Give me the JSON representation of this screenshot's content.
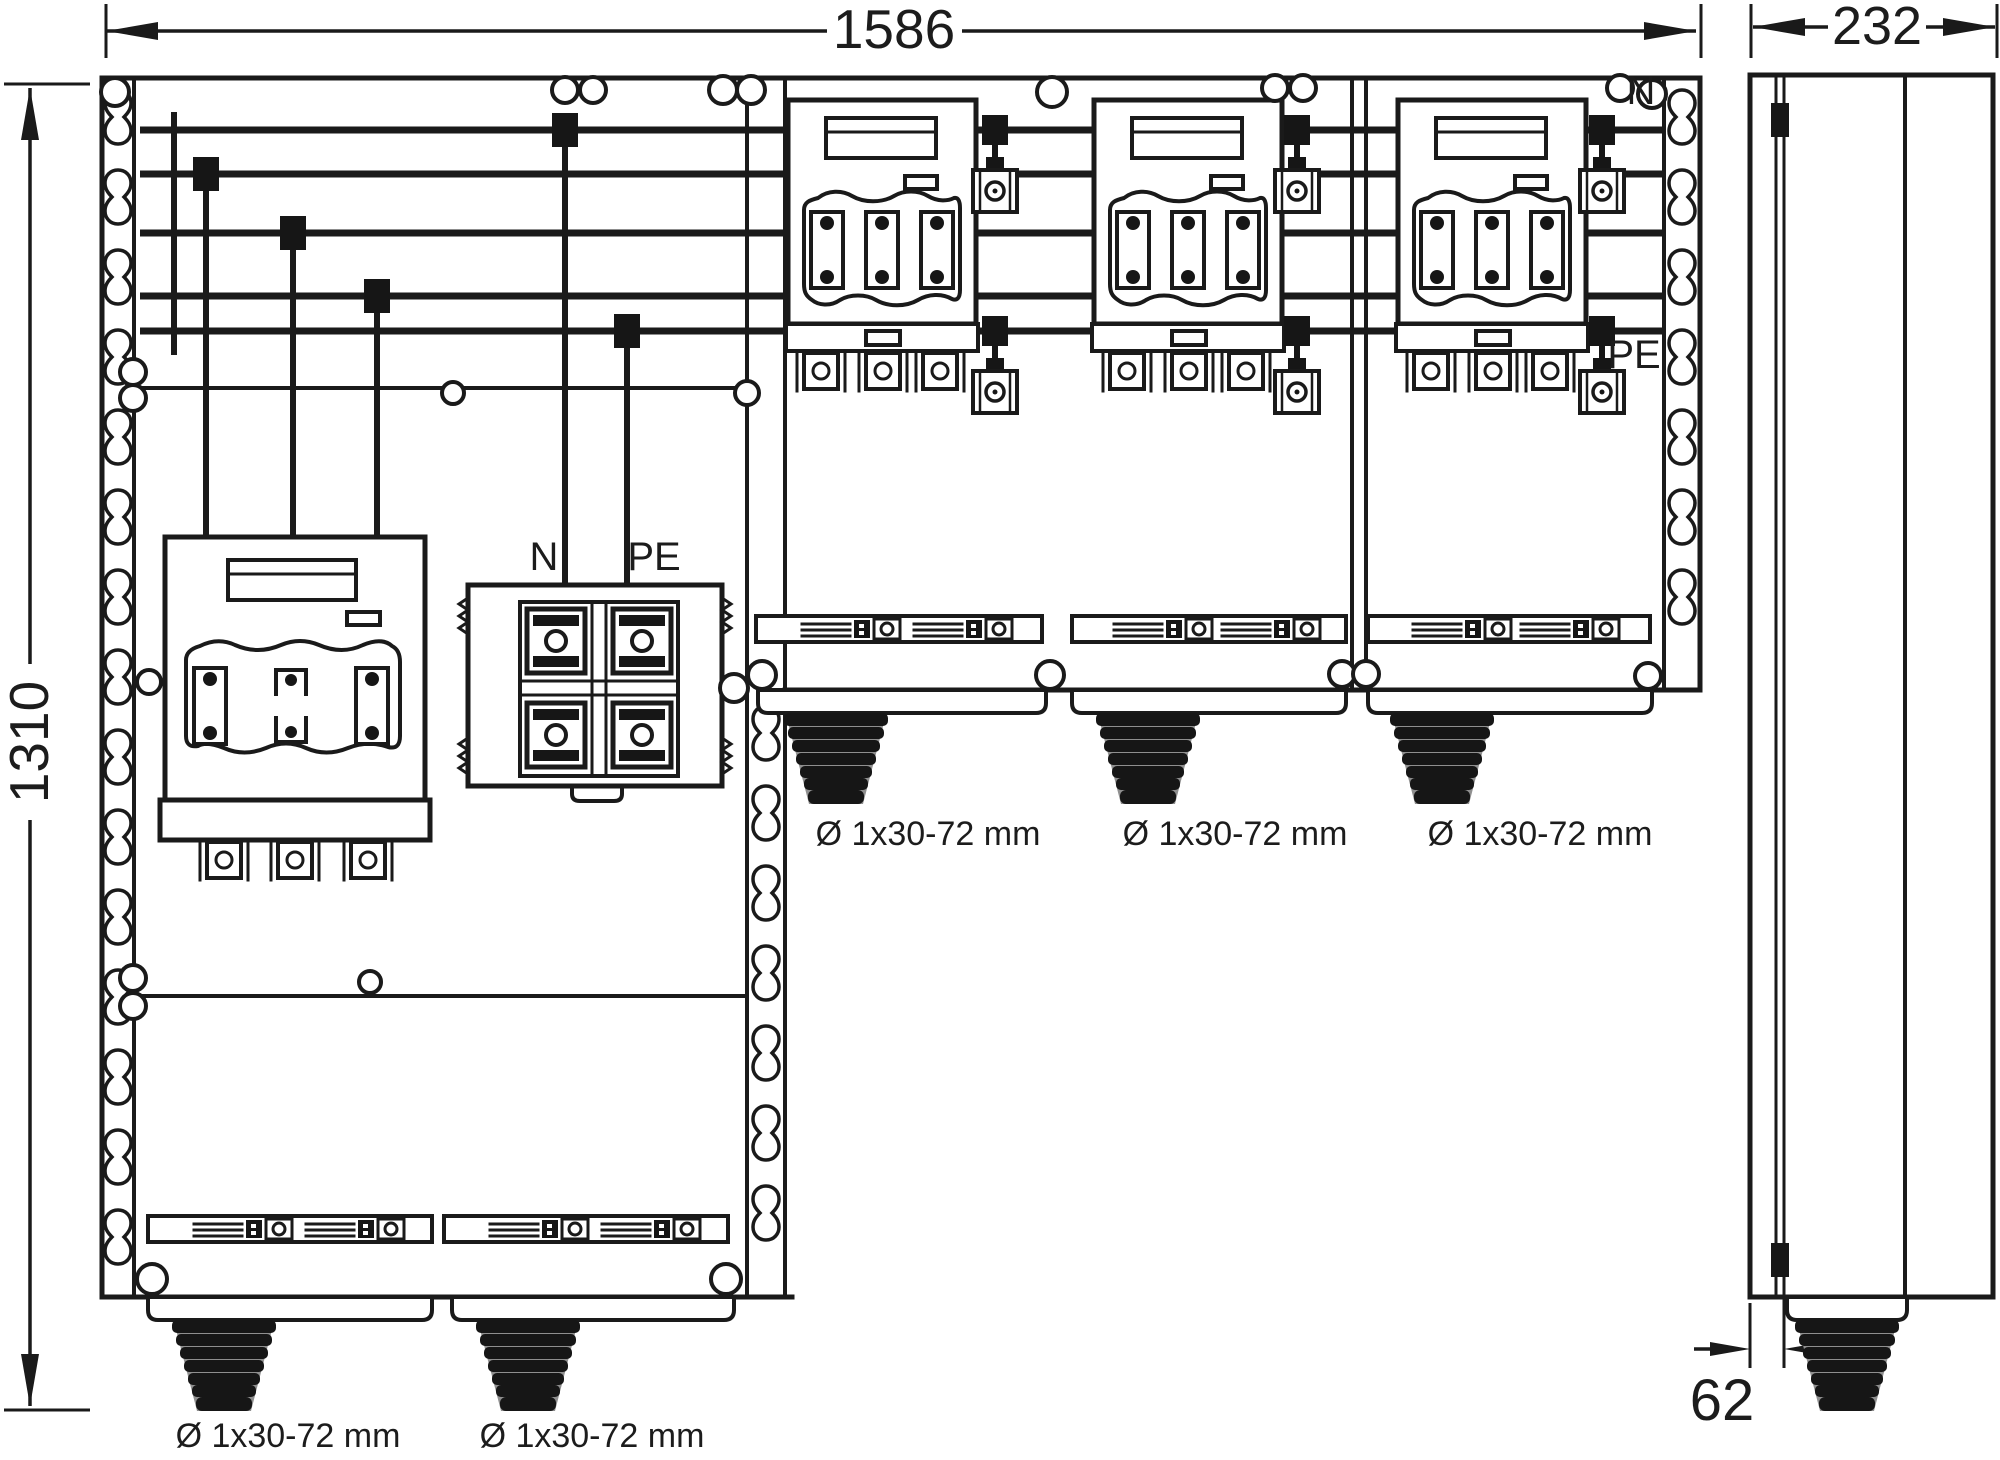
{
  "dimensions": {
    "width_mm": "1586",
    "depth_mm": "232",
    "height_mm": "1310",
    "gland_offset_mm": "62"
  },
  "busbar_labels": {
    "neutral": "N",
    "protective_earth": "PE"
  },
  "terminal_block_labels": {
    "neutral": "N",
    "protective_earth": "PE"
  },
  "gland_labels": [
    "Ø 1x30-72 mm",
    "Ø 1x30-72 mm",
    "Ø 1x30-72 mm",
    "Ø 1x30-72 mm",
    "Ø 1x30-72 mm"
  ],
  "colors": {
    "line": "#1a1a1a",
    "background": "#ffffff",
    "gland_dark": "#161616",
    "gland_shade": "#8f8f8f"
  }
}
